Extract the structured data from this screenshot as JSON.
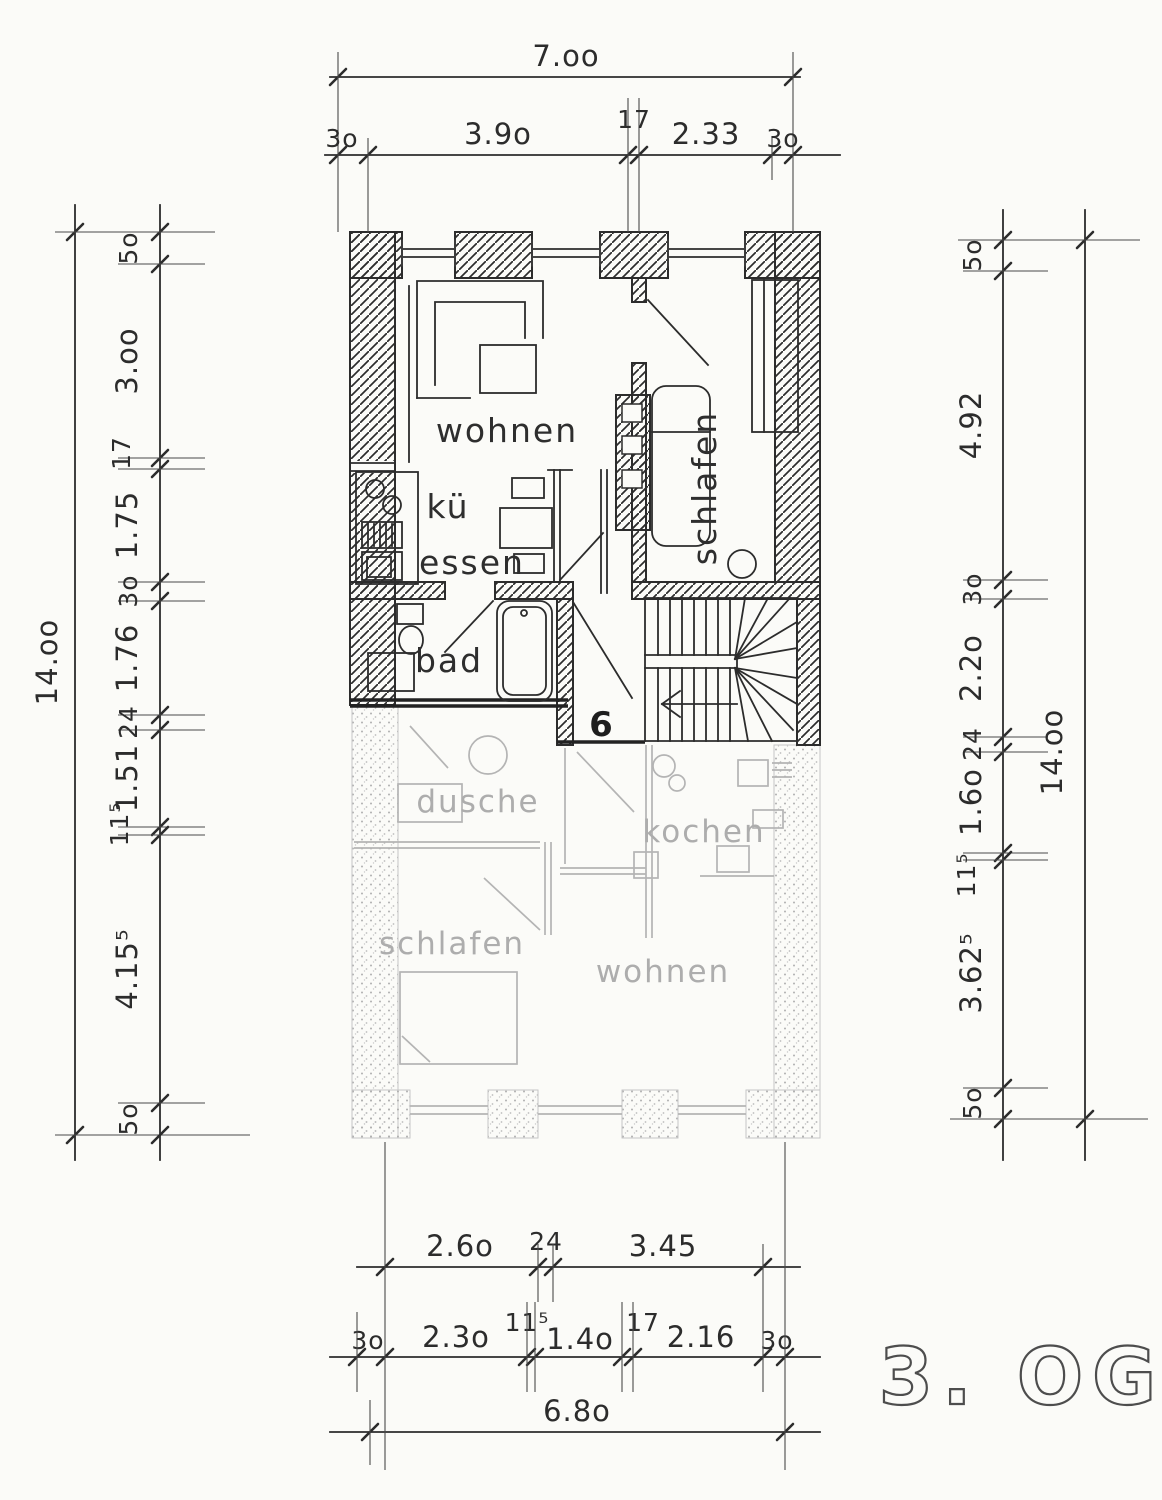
{
  "drawing": {
    "floor_label": "3. OG",
    "unit_number": "6",
    "upper_apartment": {
      "living": "wohnen",
      "kitchen": "kü",
      "dining": "essen",
      "bath": "bad",
      "bedroom": "schlafen"
    },
    "lower_apartment": {
      "shower": "dusche",
      "kitchen": "kochen",
      "bedroom": "schlafen",
      "living": "wohnen"
    }
  },
  "dims": {
    "top": {
      "total": "7.oo",
      "seg": [
        "3o",
        "3.9o",
        "17",
        "2.33",
        "3o"
      ]
    },
    "left": {
      "total": "14.oo",
      "seg": [
        "5o",
        "3.oo",
        "17",
        "1.75",
        "3o",
        "1.76",
        "24",
        "1.51",
        "11⁵",
        "4.15⁵",
        "5o"
      ]
    },
    "right": {
      "total": "14.oo",
      "seg": [
        "5o",
        "4.92",
        "3o",
        "2.2o",
        "24",
        "1.6o",
        "11⁵",
        "3.62⁵",
        "5o"
      ]
    },
    "bottom": {
      "row1": [
        "2.6o",
        "24",
        "3.45"
      ],
      "row2": [
        "3o",
        "2.3o",
        "11⁵",
        "1.4o",
        "17",
        "2.16",
        "3o"
      ],
      "total": "6.8o"
    }
  }
}
